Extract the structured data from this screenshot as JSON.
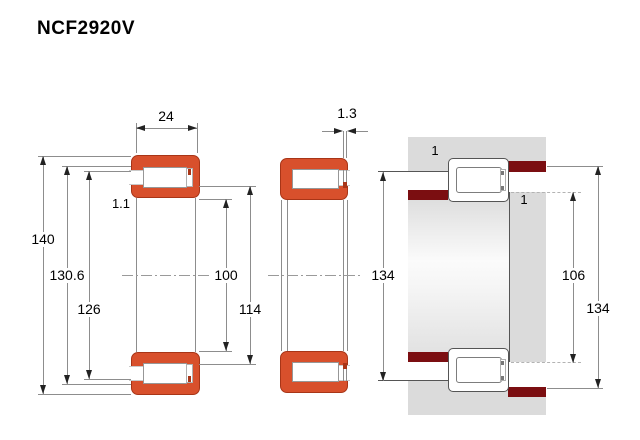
{
  "title": "NCF2920V",
  "colors": {
    "bearing_red": "#D8502C",
    "bearing_red_border": "#A83517",
    "abutment_maroon": "#7B0E11",
    "housing_gray": "#DBDBDB"
  },
  "cross_section": {
    "width_b": "24",
    "chamfer_r": "1.1",
    "outer_diameter": "140",
    "raceway_e": "130.6",
    "flange_diameter": "126",
    "bore_diameter": "100",
    "raceway_f": "114"
  },
  "displacement": {
    "axial_s": "1.3"
  },
  "mounting": {
    "abutment_left": "134",
    "abutment_shaft": "106",
    "abutment_housing": "134",
    "fillet_shaft": "1",
    "fillet_housing": "1"
  }
}
